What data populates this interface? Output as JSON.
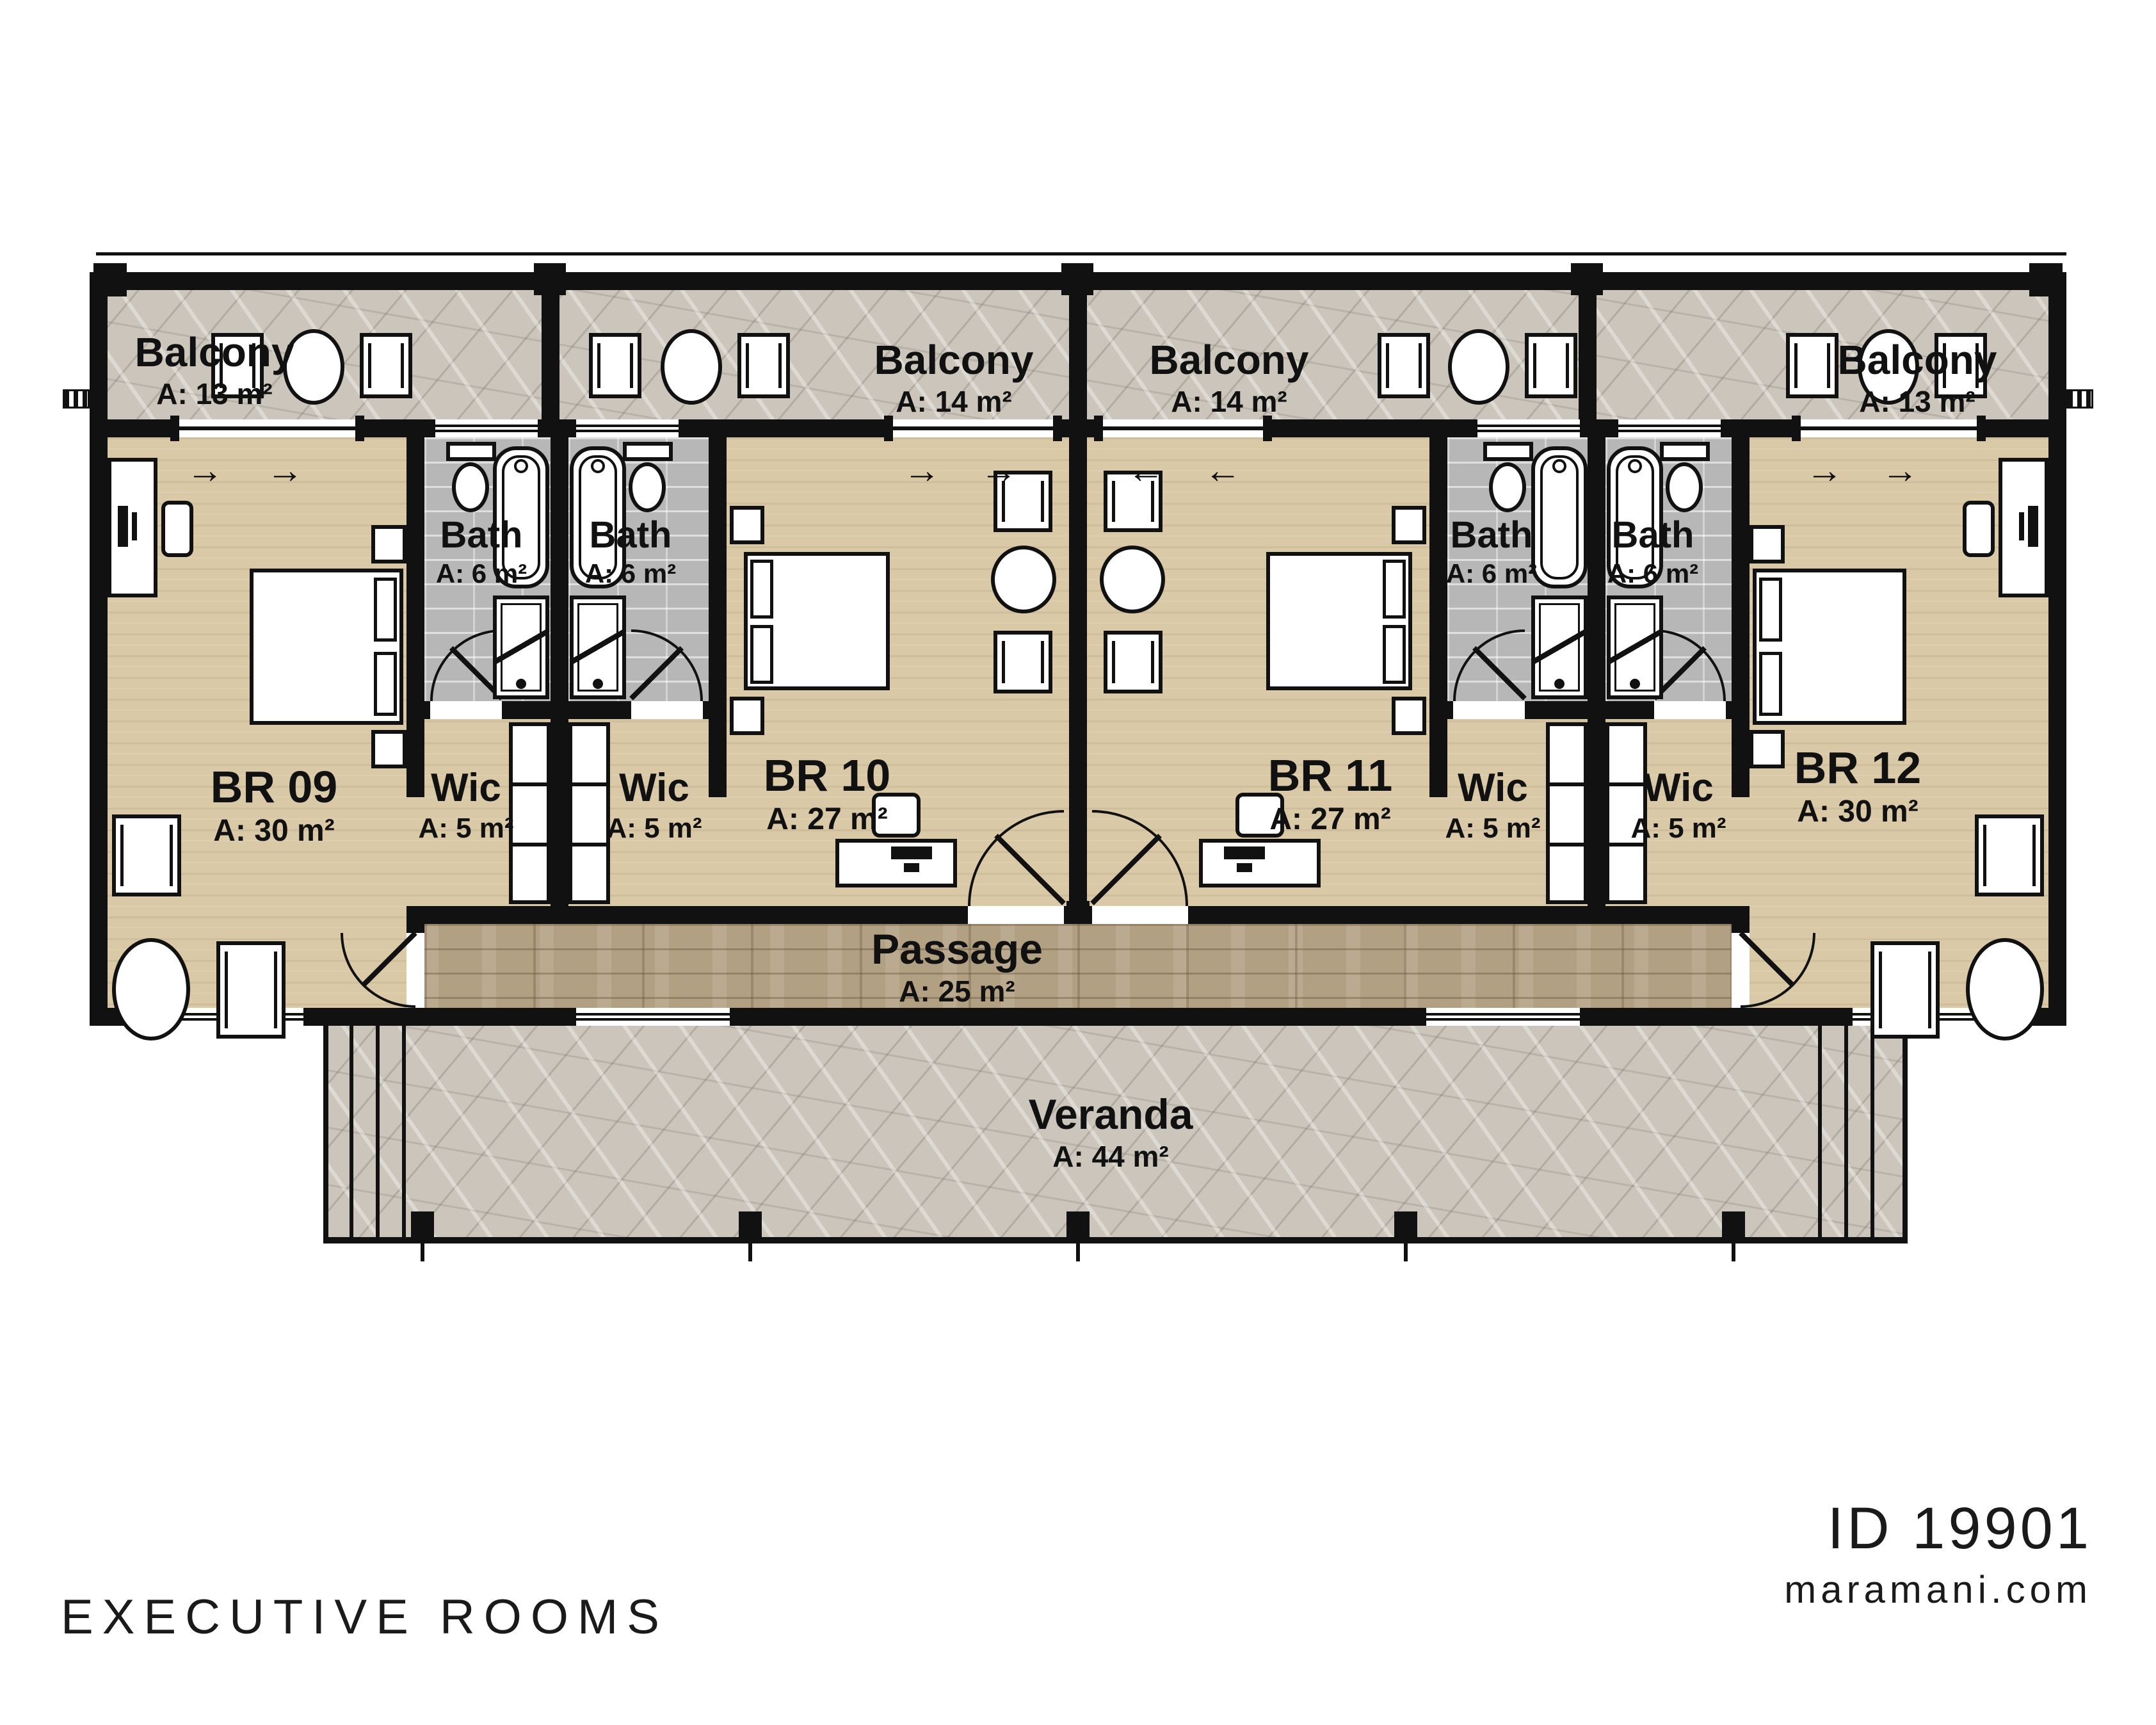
{
  "footer": {
    "title": "EXECUTIVE ROOMS",
    "plan_id": "ID 19901",
    "website": "maramani.com"
  },
  "symbols": {
    "arrow_right": "→",
    "arrow_left": "←"
  },
  "colors": {
    "wall": "#111111",
    "wood_floor": "#d9c9a7",
    "passage_floor": "#b2a082",
    "stone_floor": "#cbc5bc",
    "tile_floor": "#b7b7b7",
    "text": "#111111"
  },
  "rooms": {
    "balconies": [
      {
        "name": "Balcony",
        "area": "A: 13 m²"
      },
      {
        "name": "Balcony",
        "area": "A: 14 m²"
      },
      {
        "name": "Balcony",
        "area": "A: 14 m²"
      },
      {
        "name": "Balcony",
        "area": "A: 13 m²"
      }
    ],
    "bedrooms": [
      {
        "name": "BR 09",
        "area": "A: 30 m²"
      },
      {
        "name": "BR 10",
        "area": "A: 27 m²"
      },
      {
        "name": "BR 11",
        "area": "A: 27 m²"
      },
      {
        "name": "BR 12",
        "area": "A: 30 m²"
      }
    ],
    "baths": [
      {
        "name": "Bath",
        "area": "A: 6 m²"
      },
      {
        "name": "Bath",
        "area": "A: 6 m²"
      },
      {
        "name": "Bath",
        "area": "A: 6 m²"
      },
      {
        "name": "Bath",
        "area": "A: 6 m²"
      }
    ],
    "wics": [
      {
        "name": "Wic",
        "area": "A: 5 m²"
      },
      {
        "name": "Wic",
        "area": "A: 5 m²"
      },
      {
        "name": "Wic",
        "area": "A: 5 m²"
      },
      {
        "name": "Wic",
        "area": "A: 5 m²"
      }
    ],
    "passage": {
      "name": "Passage",
      "area": "A: 25 m²"
    },
    "veranda": {
      "name": "Veranda",
      "area": "A: 44 m²"
    }
  }
}
